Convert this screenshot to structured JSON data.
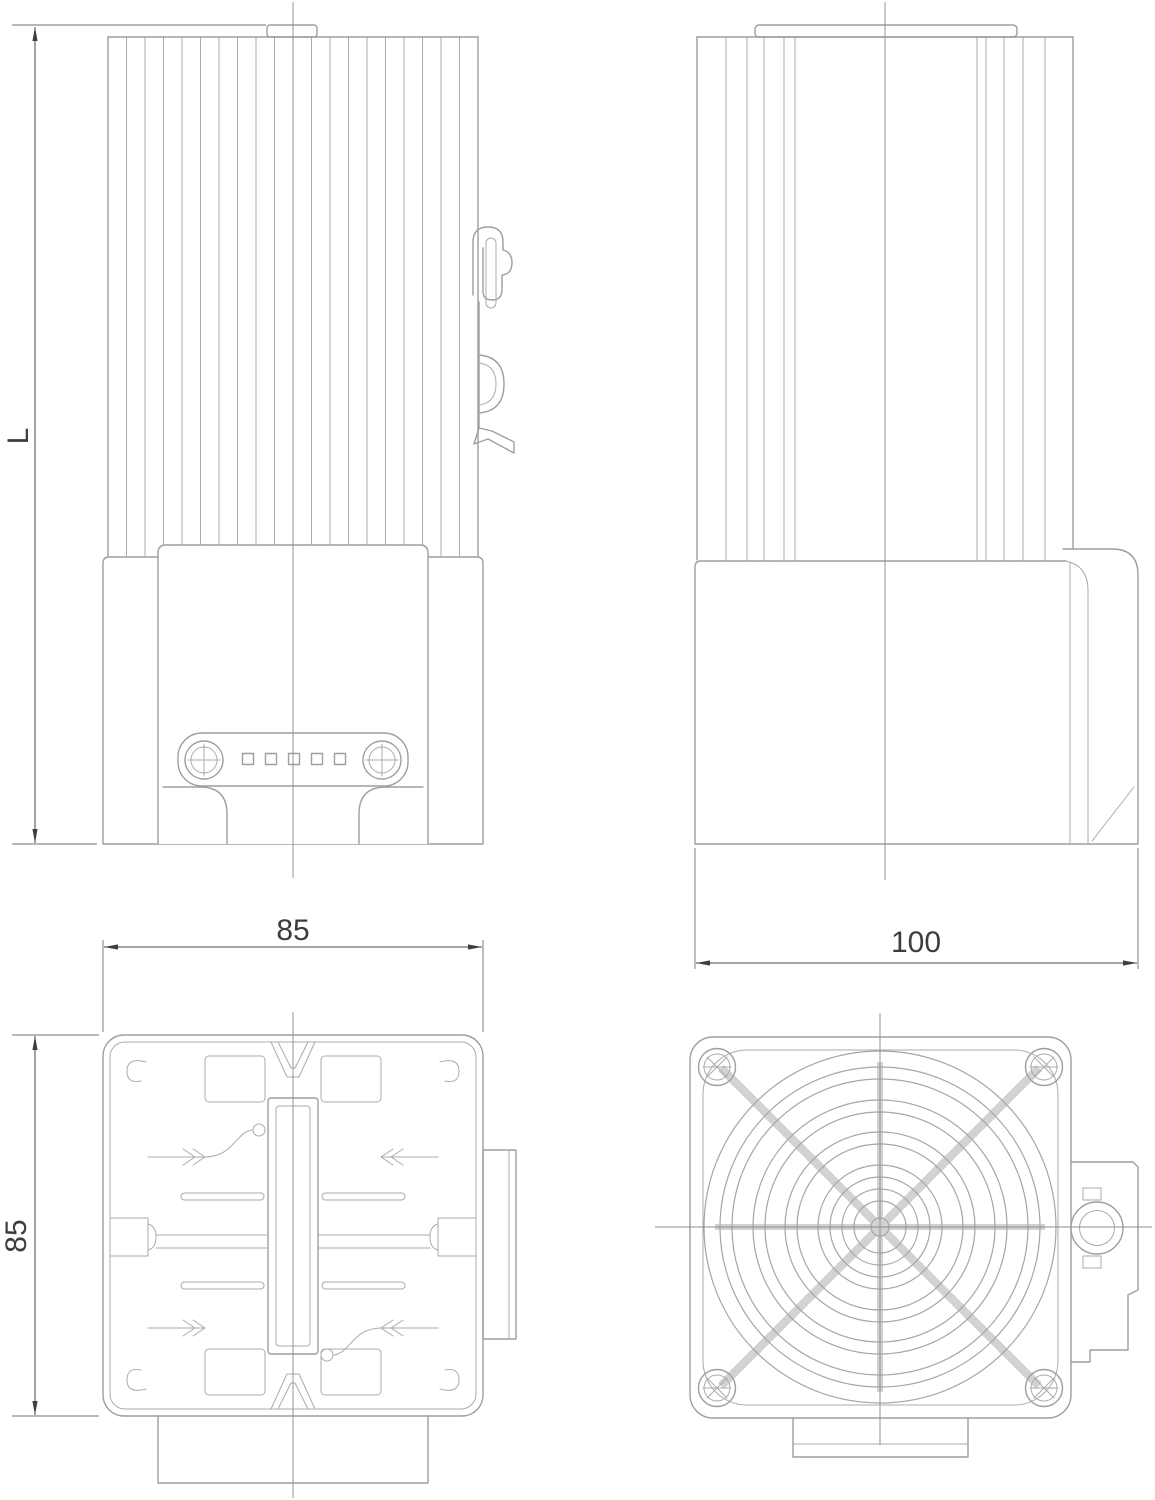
{
  "drawing": {
    "dimension_labels": {
      "front_height": "L",
      "top_width": "85",
      "top_side": "85",
      "side_depth": "100"
    },
    "colors": {
      "background": "#ffffff",
      "part_line": "#9e9e9e",
      "thin_line": "#ababab",
      "centerline": "#8c8c8c",
      "dimension_line": "#454545",
      "dimension_text": "#3d3d3d",
      "grille_spoke": "#d2d2d2"
    }
  }
}
